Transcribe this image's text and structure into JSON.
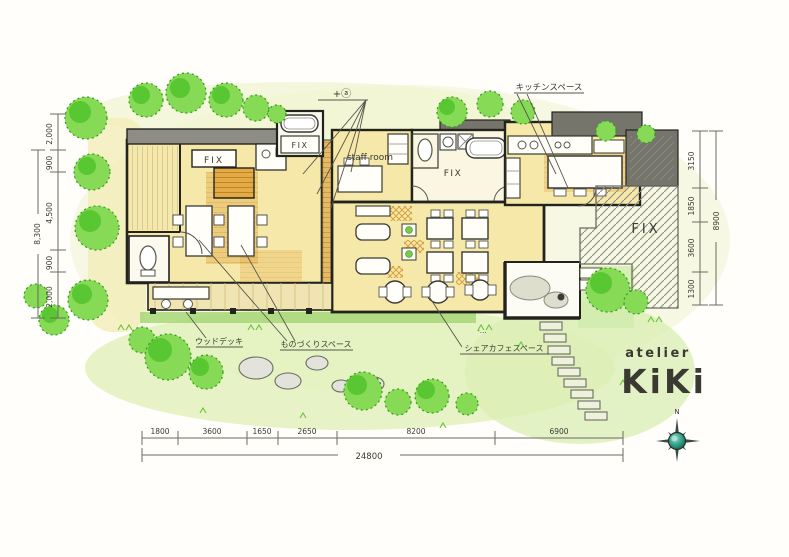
{
  "title": "atelier Kiki floor plan",
  "annotations": {
    "plus_a": "+ⓐ",
    "kitchen_space": "キッチンスペース",
    "staff_room": "staff room",
    "fix": "FIX",
    "wood_deck": "ウッドデッキ",
    "craft_space": "ものづくりスペース",
    "share_cafe_space": "シェアカフェスペース",
    "dash_dots": "‐…"
  },
  "logo": {
    "sub": "atelier",
    "main": "KiKi"
  },
  "compass": {
    "north": "N"
  },
  "dimensions": {
    "left": {
      "segments": [
        "2,000",
        "900",
        "4,500",
        "900",
        "2,000"
      ],
      "total": "8,300"
    },
    "right": {
      "segments": [
        "3150",
        "1850",
        "3600",
        "1300"
      ],
      "total": "8900"
    },
    "bottom": {
      "segments": [
        "1800",
        "3600",
        "1650",
        "2650",
        "8200",
        "6900"
      ],
      "total": "24800"
    }
  },
  "colors": {
    "tree_green": "#66d23a",
    "tree_dark": "#3fae22",
    "floor_yellow": "#f6e8a9",
    "wood_orange": "#dfa13c",
    "wall_gray": "#8d8d85",
    "wall_dark": "#75756c",
    "ink": "#23231e",
    "compass_teal": "#2e9c86"
  }
}
